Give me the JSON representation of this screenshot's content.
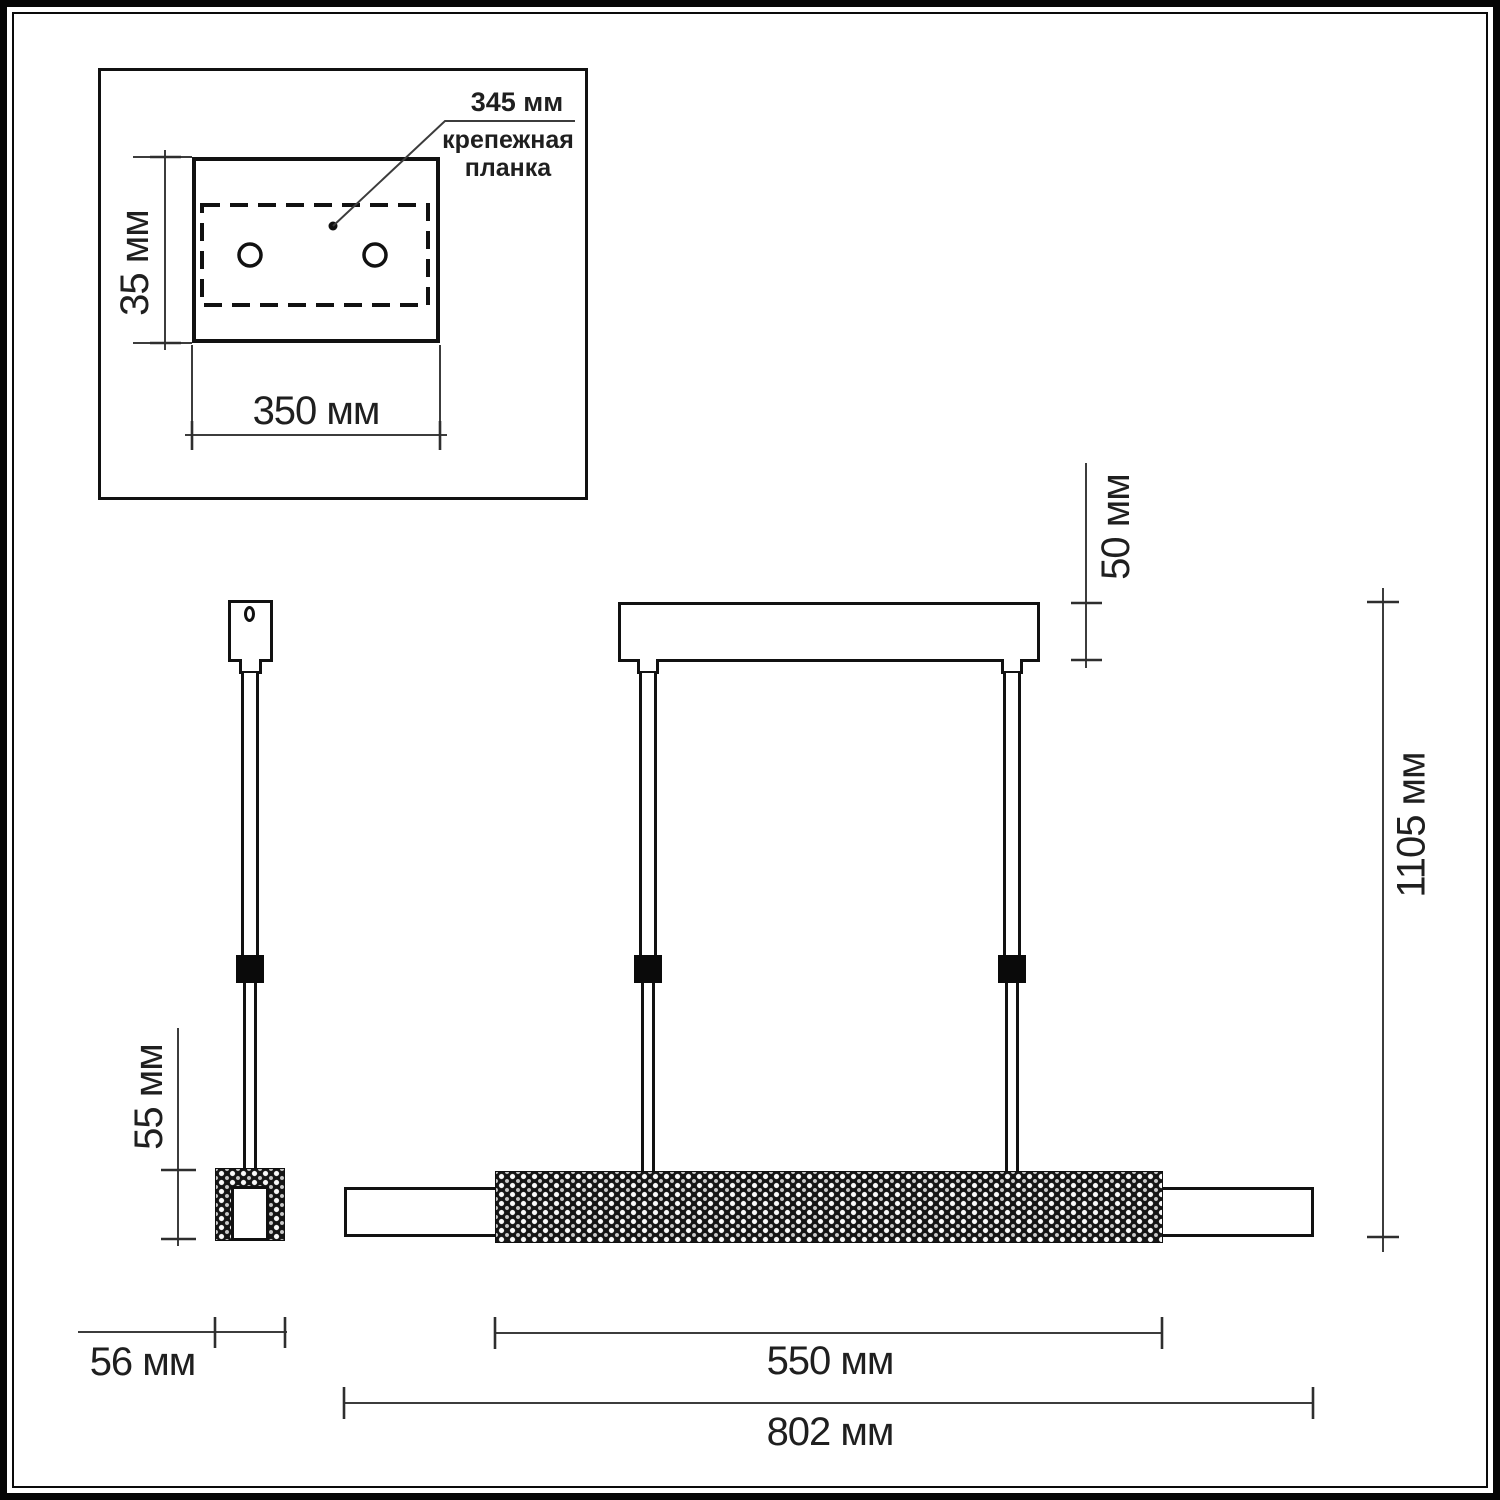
{
  "title": "pendant-light-dimension-drawing",
  "colors": {
    "background": "#ffffff",
    "outline": "#111111",
    "dimension_line": "#3c3c3c",
    "connector_fill": "#0a0a0a",
    "crystal_texture": "#151515"
  },
  "inset": {
    "mounting_bar_length": "345 мм",
    "mounting_bar_caption": "крепежная\nпланка",
    "plate_height": "35 мм",
    "plate_width": "350 мм"
  },
  "side_view": {
    "fixture_height": "55 мм",
    "fixture_width": "56 мм"
  },
  "front_view": {
    "canopy_height": "50 мм",
    "overall_height": "1105 мм",
    "crystal_section_length": "550 мм",
    "overall_length": "802 мм"
  }
}
